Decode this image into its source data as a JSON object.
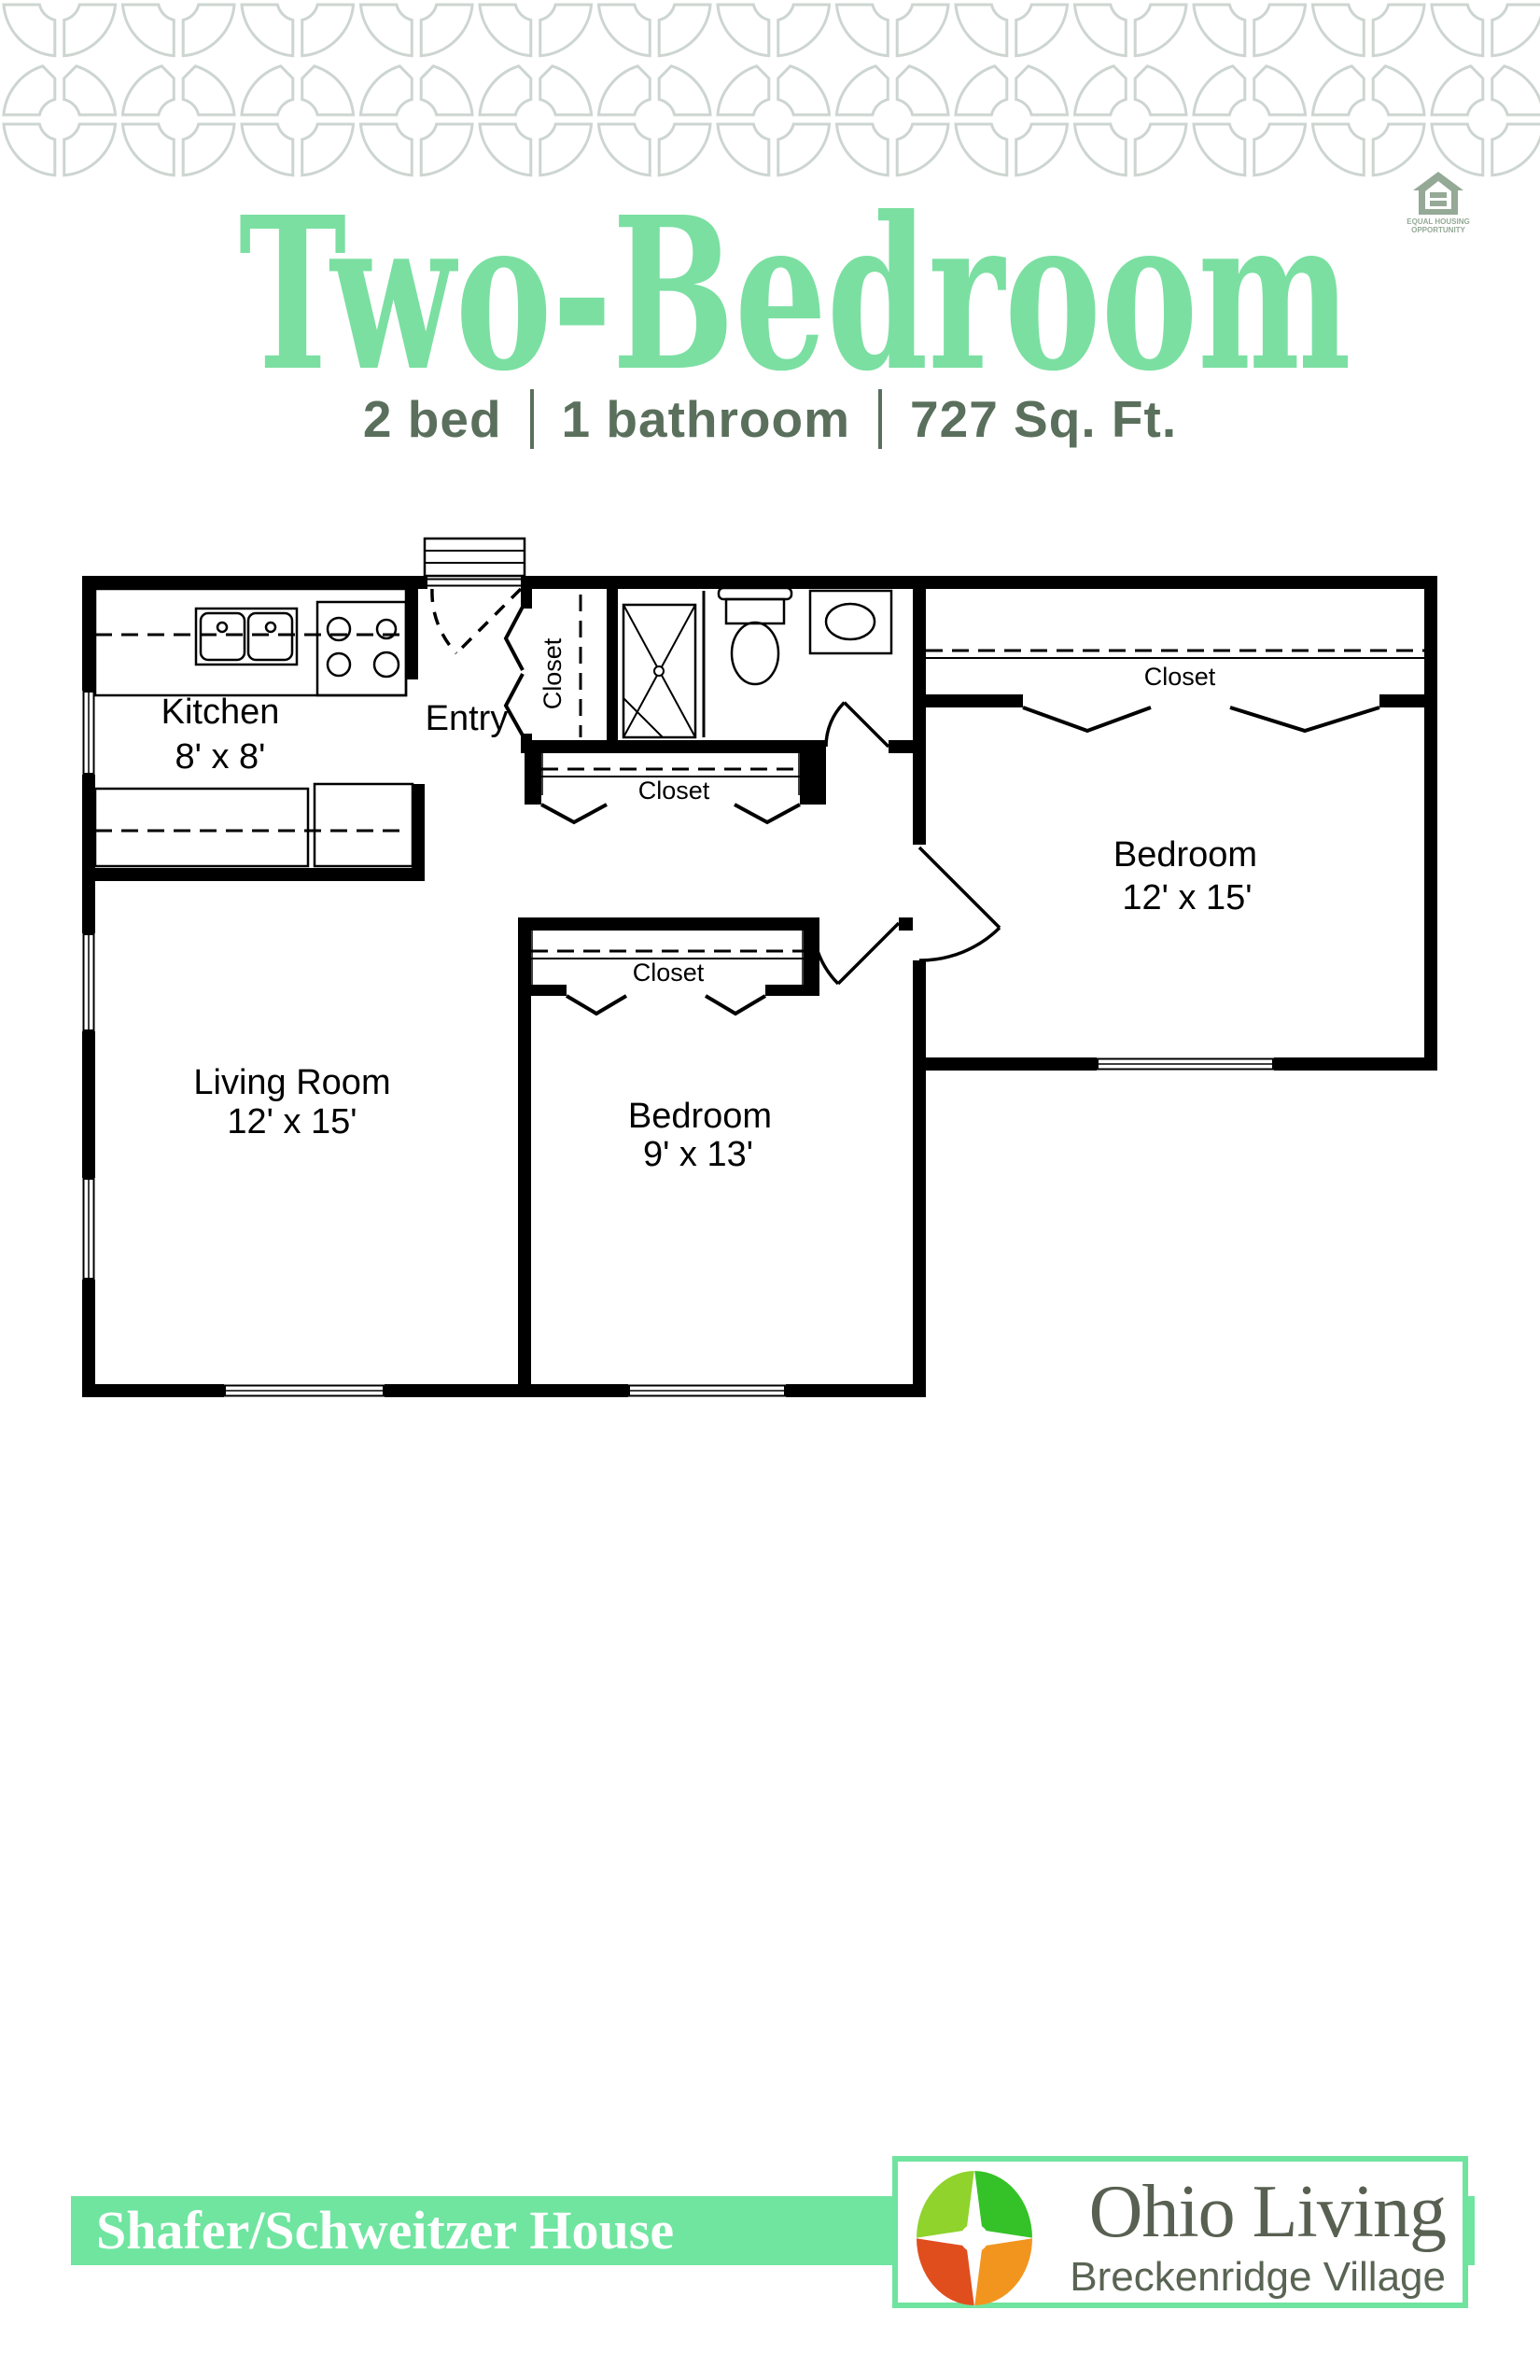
{
  "header": {
    "title": "Two-Bedroom",
    "title_color": "#7BDFA2",
    "specs": [
      "2 bed",
      "1 bathroom",
      "727 Sq. Ft."
    ],
    "specs_color": "#5A6F5C"
  },
  "pattern": {
    "color": "#CDD5D1"
  },
  "eho": {
    "color": "#94A996",
    "line1": "EQUAL HOUSING",
    "line2": "OPPORTUNITY"
  },
  "floorplan": {
    "rooms": [
      {
        "name": "Kitchen",
        "dims": "8' x 8'"
      },
      {
        "name": "Entry"
      },
      {
        "name": "Living Room",
        "dims": "12' x 15'"
      },
      {
        "name": "Bedroom",
        "dims": "12' x 15'"
      },
      {
        "name": "Bedroom",
        "dims": "9' x 13'"
      }
    ],
    "closets": {
      "entry": "Closet",
      "hall": "Closet",
      "bedroom1": "Closet",
      "bedroom2": "Closet"
    },
    "line_color": "#000000"
  },
  "footer": {
    "bar_color": "#6FE5A0",
    "house_name": "Shafer/Schweitzer House",
    "brand": "Ohio Living",
    "brand_color": "#586052",
    "community": "Breckenridge Village",
    "community_color": "#5A6454",
    "box_border_color": "#6FE49E",
    "logo_colors": {
      "tl": "#8FD32C",
      "tr": "#35C228",
      "bl": "#E04E1E",
      "br": "#F2951F"
    }
  }
}
